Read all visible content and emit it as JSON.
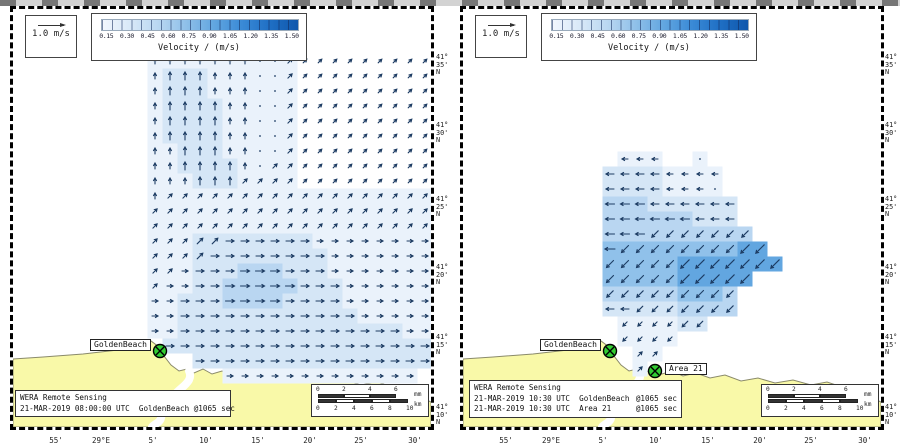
{
  "figure": {
    "width": 900,
    "height": 444,
    "background": "#ffffff"
  },
  "colors": {
    "land": "#f9f9a8",
    "sea": "#ffffff",
    "coastline": "#8a8a6a",
    "river": "#ffffff",
    "arrow": "#1d3c63",
    "marker_fill": "#33cc33",
    "marker_stroke": "#000000",
    "velocity_levels": [
      "#eaf2fb",
      "#d5e6f6",
      "#b9d6f1",
      "#90c1ea",
      "#62a6e0"
    ],
    "colorbar_gradient": [
      "#f2f7fd",
      "#d9e9f8",
      "#b9d7f1",
      "#8fc0e9",
      "#62a6e0",
      "#3a8ad6",
      "#1f6fc4",
      "#0f57ac"
    ]
  },
  "legend": {
    "ref_arrow_label": "1.0 m/s"
  },
  "colorbar": {
    "title": "Velocity / (m/s)",
    "ticks": [
      "0.15",
      "0.30",
      "0.45",
      "0.60",
      "0.75",
      "0.90",
      "1.05",
      "1.20",
      "1.35",
      "1.50"
    ]
  },
  "axes": {
    "x_ticks": [
      "55'",
      "29°E",
      "5'",
      "10'",
      "15'",
      "20'",
      "25'",
      "30'"
    ],
    "y_ticks": [
      [
        "41°",
        "35'",
        "N"
      ],
      [
        "41°",
        "30'",
        "N"
      ],
      [
        "41°",
        "25'",
        "N"
      ],
      [
        "41°",
        "20'",
        "N"
      ],
      [
        "41°",
        "15'",
        "N"
      ],
      [
        "41°",
        "10'",
        "N"
      ]
    ]
  },
  "scalebar": {
    "mm_labels": [
      "0",
      "2",
      "4",
      "6"
    ],
    "mm_unit": "mm",
    "km_labels": [
      "0",
      "2",
      "4",
      "6",
      "8",
      "10"
    ],
    "km_unit": "km"
  },
  "panels": [
    {
      "id": "left",
      "info_lines": [
        {
          "left": "WERA Remote Sensing",
          "right": ""
        },
        {
          "left": "21-MAR-2019 08:00:00 UTC  GoldenBeach @1065 sec",
          "right": ""
        }
      ],
      "markers": [
        {
          "label": "GoldenBeach",
          "x": 147,
          "y": 342,
          "label_side": "left"
        }
      ],
      "field": {
        "origin_x": 142,
        "origin_y": 52,
        "cell": 15,
        "intensity": [
          "1111111111.........",
          "1222111111.........",
          "1222111111.........",
          "1222211111.........",
          "1222211111.........",
          "1222211111.........",
          "1122211111.........",
          "1122221111.........",
          "1112221111.........",
          "1111111111111111111",
          "1111111111111111111",
          "1111111111111111111",
          "1112222222211111111",
          "1112222222221111111",
          "1112223332221111111",
          "1112233333222111111",
          "1122233332222111111",
          "1122222222222211111",
          "1122222222222222211",
          ".222222222222222222",
          "...2222222222222222",
          ".....1111111111111."
        ],
        "direction": [
          "nnnnnnnoouuuuuuuuuu",
          "nnnnnnnoouuuuuuuuuu",
          "nnnnnnnoouuuuuuuuuu",
          "nnnnnnnoouuuuuuuuuu",
          "nnnnnnnoouuuuuuuuuu",
          "nnnnnnnoouuuuuuuuuu",
          "nnnnnnnoouuuuuuuuuu",
          "nnnnnnnouuuuuuuuuuu",
          "nnnnnnuuuuuuuuuuuuu",
          "nuuuuuuuuuuuuuuuuuu",
          "uuuuuuuuuuuuuuuuuuu",
          "uuuuuuuuuuuuuuuuuuu",
          "uuuuueeeeeeeeeeeeee",
          "uuuueeeeeeeeeeeeeee",
          "uueeeeeeeeeeeeeeeee",
          "ueeeeeeeeeeeeeeeeee",
          "eeeeeeeeeeeeeeeeeee",
          "eeeeeeeeeeeeeeeeeee",
          "eeeeeeeeeeeeeeeeeee",
          ".eeeeeeeeeeeeeeeeee",
          "...eeeeeeeeeeeeeeee",
          ".....eeeeeeeeeeeee."
        ]
      }
    },
    {
      "id": "right",
      "info_lines": [
        {
          "left": "WERA Remote Sensing",
          "right": ""
        },
        {
          "left": "21-MAR-2019 10:30 UTC  GoldenBeach",
          "right": "@1065 sec"
        },
        {
          "left": "21-MAR-2019 10:30 UTC  Area 21",
          "right": "@1065 sec"
        }
      ],
      "markers": [
        {
          "label": "GoldenBeach",
          "x": 147,
          "y": 342,
          "label_side": "left"
        },
        {
          "label": "Area 21",
          "x": 192,
          "y": 362,
          "label_side": "right"
        }
      ],
      "field": {
        "origin_x": 147,
        "origin_y": 150,
        "cell": 15,
        "intensity": [
          ".111..1......",
          "22221111.....",
          "22221111.....",
          "333222222....",
          "333333222....",
          "3333333333...",
          "44444444455..",
          "444445555555.",
          "4444455555...",
          "333334443....",
          "222223333....",
          ".111122......",
          ".1111........",
          "..11.........",
          "..1.........."
        ],
        "direction": [
          ".www..o......",
          "wwwwwwww.....",
          "wwwwwwwo.....",
          "wwwwwwwww....",
          "wwwwwwwww....",
          "wwwzzzzzzz...",
          "wzzzzzzzzzz..",
          "zzzzzzzzzzzz.",
          "zzzzzzzzzz...",
          "zzzzzzzzz....",
          "wwzzzzzzz....",
          ".zzzzzz......",
          ".zzzz........",
          "..uu.........",
          "..u.........."
        ]
      }
    }
  ]
}
